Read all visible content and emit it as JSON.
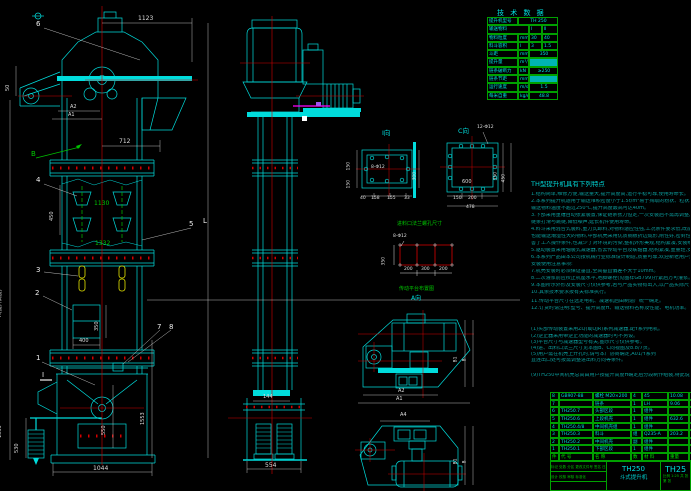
{
  "colors": {
    "background": "#000000",
    "line_cyan": "#00dcdc",
    "line_red": "#d40000",
    "line_green": "#00c000",
    "line_yellow": "#e6e600",
    "line_magenta": "#ff00ff",
    "dim_white": "#dedede",
    "table_green": "#00a000",
    "text_teal": "#0b9b9b"
  },
  "labels": {
    "front": {
      "balloon_6": "6",
      "dim_1123": "1123",
      "dim_a2": "A2",
      "dim_a1": "A1",
      "dim_50": "50",
      "dim_712": "712",
      "section_b": "B",
      "balloon_4": "4",
      "dim_450": "450",
      "dim_1130": "1130",
      "dim_1332": "1332",
      "balloon_3": "3",
      "balloon_2": "2",
      "dim_350": "350",
      "dim_400": "400",
      "section_i": "I",
      "balloon_1": "1",
      "balloon_7": "7",
      "balloon_8": "8",
      "balloon_5": "5",
      "dim_l": "L",
      "dim_h": "H(提升高度)",
      "dim_1553_left": "1553",
      "dim_530": "530",
      "dim_550": "550",
      "dim_1553_right": "1553",
      "dim_1044": "1044"
    },
    "side": {
      "dim_144": "144",
      "dim_554": "554"
    },
    "view_i": {
      "title": "I向",
      "holes": "8-Φ12",
      "dim_300": "300",
      "dim_150a": "150",
      "dim_150b": "150",
      "dim_40": "40",
      "dim_158": "158",
      "dim_155": "155",
      "dim_33": "33"
    },
    "view_c": {
      "title": "C向",
      "holes": "12-Φ12",
      "dim_600": "600",
      "dim_350": "350",
      "dim_450": "450",
      "dim_150": "150",
      "dim_200": "200",
      "dim_478": "478"
    },
    "inlet": {
      "title": "进料口法兰螺孔尺寸",
      "holes": "8-Φ12",
      "dim_350": "350",
      "dim_200a": "200",
      "dim_300": "300",
      "dim_200b": "200"
    },
    "drive_top": {
      "caption": "传动平台布置图",
      "view_label": "A向",
      "dim_b1": "B1",
      "dim_b": "B",
      "dim_a2": "A2",
      "dim_a1": "A1"
    },
    "drive_bottom": {
      "dim_a4": "A4",
      "dim_b1": "B1",
      "dim_b": "B"
    }
  },
  "tech_table": {
    "title": "技 术 数 据",
    "rows": [
      {
        "label": "提升机型号",
        "unit": "",
        "value": "TH 250"
      },
      {
        "label": "输送物料",
        "unit": "",
        "v1": "Ⅰ",
        "v2": "Ⅱ"
      },
      {
        "label": "物料粒度",
        "unit": "mm",
        "v1": "30",
        "v2": "40"
      },
      {
        "label": "料斗容积",
        "unit": "l",
        "v1": "3",
        "v2": "1.5"
      },
      {
        "label": "斗距",
        "unit": "mm",
        "value": "350"
      },
      {
        "label": "提升量",
        "unit": "m³/h",
        "value": ""
      },
      {
        "label": "链条破断力",
        "unit": "kN",
        "value": "≥250"
      },
      {
        "label": "链条节距",
        "unit": "mm",
        "value": ""
      },
      {
        "label": "运行速度",
        "unit": "m/s",
        "value": "1.5"
      },
      {
        "label": "每米自重",
        "unit": "kg/m",
        "value": "48.8"
      }
    ]
  },
  "notes": {
    "title": "TH型提升机具有下列特点",
    "lines": [
      "1.结构简单,维修方便,输送量大,提升高度高,运行平稳可靠,使用寿命长。",
      "2.本系列提升机适用于输送堆积密度小于1.5t/m³易于掏取的粉状、粒状、小块状物料,如煤、水泥、碎石、砂、化肥、粮食等。",
      "输送物料温度不超过250℃,提升高度最高可达40m。",
      "3.下部采用重锤自动张紧装置,保证链条张力恒定,一次安装后不需再调整,方便用户,并可有效防止",
      "链条打滑与跳链,降低噪声,延长机件使用寿命。",
      "4.料斗采用混合式装料,重力式卸料,对物料适应性强,工况条件要求低,既能输送干燥易扬尘的物料,",
      "也能输送潮湿性大的物料,中部机壳采用优质钢板折边成形,刚性好,密封性强,粉尘不外溢,既改",
      "善了工人操作条件,也减少了对环境的污染,整机外形美观,结构紧凑,安装维修方便,运转率高。",
      "5.驱动装置采用轴装式减速器,省去传动平台及联轴器,结构紧凑,重量轻,安装维修方便,运行可靠。",
      "6.本系列产品由本公司按机械行业标准设计制造,质量可靠,欢迎新老用户选购。",
      "安装使用注意事项:",
      "7.机壳安装时必须保证垂直,全高垂直偏差不大于10mm。",
      "8.二次灌浆前应校正机座水平,地脚螺栓(见图样GB799)拧紧后方可灌浆。",
      "9.本图所示外形及安装尺寸仅供参考,若与产品实物有出入,以产品实际尺寸为准。",
      "10.其余技术要求按有关标准执行。",
      "11.传动平台尺寸在选定电机、减速机后由制造厂统一确定。",
      "12.订货时请注明:型号、提升高度H、输送物料名称及性能、电机功率。",
      "(1)头部传动装置采用ZQ(或QJR)系列减速器,配Y系列电机。",
      "(2)逆止器采用带逆止功能的减速器时可不另设。",
      "(3)平台尺寸与减速器型号有关,图示尺寸仅供参考。",
      "(4)进、出料口法兰尺寸见本图B、C向视图及8.8/7页。",
      "(5)用户需在机壳上开孔时,请与本厂协商确定,A01/Y系列",
      "直连出口处可按需调整进出料方向等条件。",
      "(9)TH250中间机壳总高由用户按提升高度H确定后分段制作组装,特此说明。"
    ]
  },
  "bom": {
    "headers": [
      "件号",
      "代 号",
      "名 称",
      "数量",
      "材 料",
      "重量",
      "备注"
    ],
    "rows": [
      {
        "no": "8",
        "code": "GB907-88",
        "name": "螺栓 M20×200",
        "qty": "4",
        "mat": "45",
        "wt": "10.08",
        "note": "标准件"
      },
      {
        "no": "7",
        "code": "",
        "name": "链条",
        "qty": "1",
        "mat": "LH",
        "wt": "9.06",
        "note": "外购件"
      },
      {
        "no": "6",
        "code": "TH250.7",
        "name": "头部区段",
        "qty": "1",
        "mat": "组件",
        "wt": "",
        "note": ""
      },
      {
        "no": "5",
        "code": "TH250.6",
        "name": "上段机壳",
        "qty": "1",
        "mat": "组件",
        "wt": "632.6",
        "note": ""
      },
      {
        "no": "4",
        "code": "TH250.4/8",
        "name": "中间机壳组",
        "qty": "1",
        "mat": "组件",
        "wt": "",
        "note": ""
      },
      {
        "no": "3",
        "code": "TH250.3",
        "name": "料斗",
        "qty": "组",
        "mat": "Q235-A",
        "wt": "203.2",
        "note": ""
      },
      {
        "no": "2",
        "code": "TH250.2",
        "name": "中间机壳",
        "qty": "副",
        "mat": "组件",
        "wt": "",
        "note": ""
      },
      {
        "no": "1",
        "code": "TH250.1",
        "name": "下部区段",
        "qty": "1",
        "mat": "组件",
        "wt": "",
        "note": ""
      }
    ]
  },
  "title_block": {
    "model": "TH250",
    "product": "斗式提升机",
    "model_right": "TH25",
    "rev_row": "标记 处数 分区 更改文件号 签名 日期",
    "sign_row": "设计  校核  审核  标准化",
    "scale_row": "比例 1:25  共 张 第 张"
  }
}
